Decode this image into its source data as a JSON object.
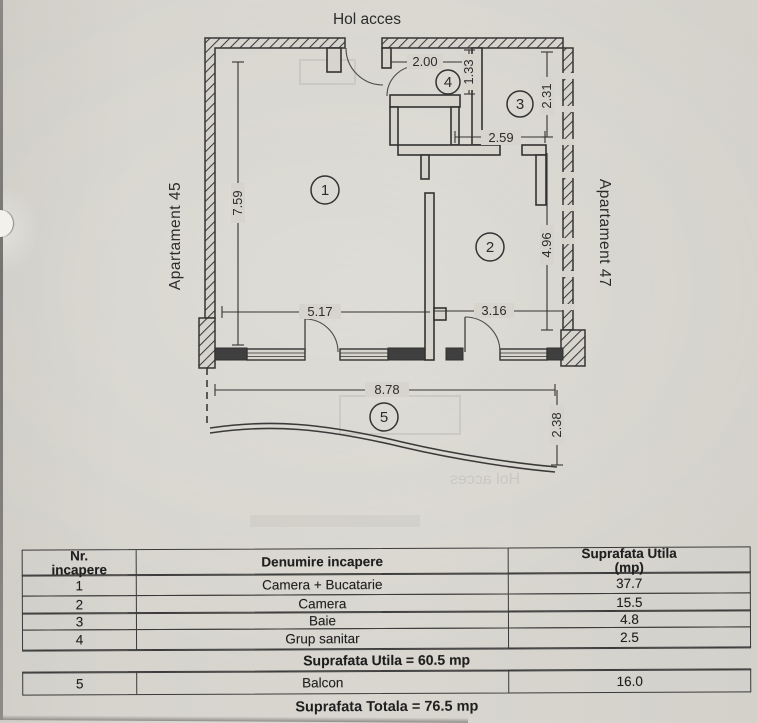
{
  "plan": {
    "labels": {
      "hol_acces": "Hol acces",
      "apartament_left": "Apartament 45",
      "apartament_right": "Apartament 47"
    },
    "rooms": [
      {
        "number": "1"
      },
      {
        "number": "2"
      },
      {
        "number": "3"
      },
      {
        "number": "4"
      },
      {
        "number": "5"
      }
    ],
    "dimensions": {
      "wc_width": "2.00",
      "wc_height": "1.33",
      "baie_height": "2.31",
      "hall_width": "2.59",
      "room1_height": "7.59",
      "room2_height": "4.96",
      "room1_width": "5.17",
      "room2_width": "3.16",
      "balcony_width": "8.78",
      "balcony_depth": "2.38"
    },
    "ghost_text": "Hol acces"
  },
  "table": {
    "headers": {
      "col1_line1": "Nr.",
      "col1_line2": "incapere",
      "col2": "Denumire incapere",
      "col3_line1": "Suprafata Utila",
      "col3_line2": "(mp)"
    },
    "rows": [
      {
        "nr": "1",
        "name": "Camera + Bucatarie",
        "area": "37.7"
      },
      {
        "nr": "2",
        "name": "Camera",
        "area": "15.5"
      },
      {
        "nr": "3",
        "name": "Baie",
        "area": "4.8"
      },
      {
        "nr": "4",
        "name": "Grup sanitar",
        "area": "2.5"
      }
    ],
    "subtotal": "Suprafata Utila = 60.5 mp",
    "balcony_row": {
      "nr": "5",
      "name": "Balcon",
      "area": "16.0"
    },
    "total": "Suprafata Totala = 76.5 mp"
  },
  "colors": {
    "paper": "#d6d4cd",
    "ink": "#2e2e2e",
    "wall": "#3a3a3a"
  }
}
